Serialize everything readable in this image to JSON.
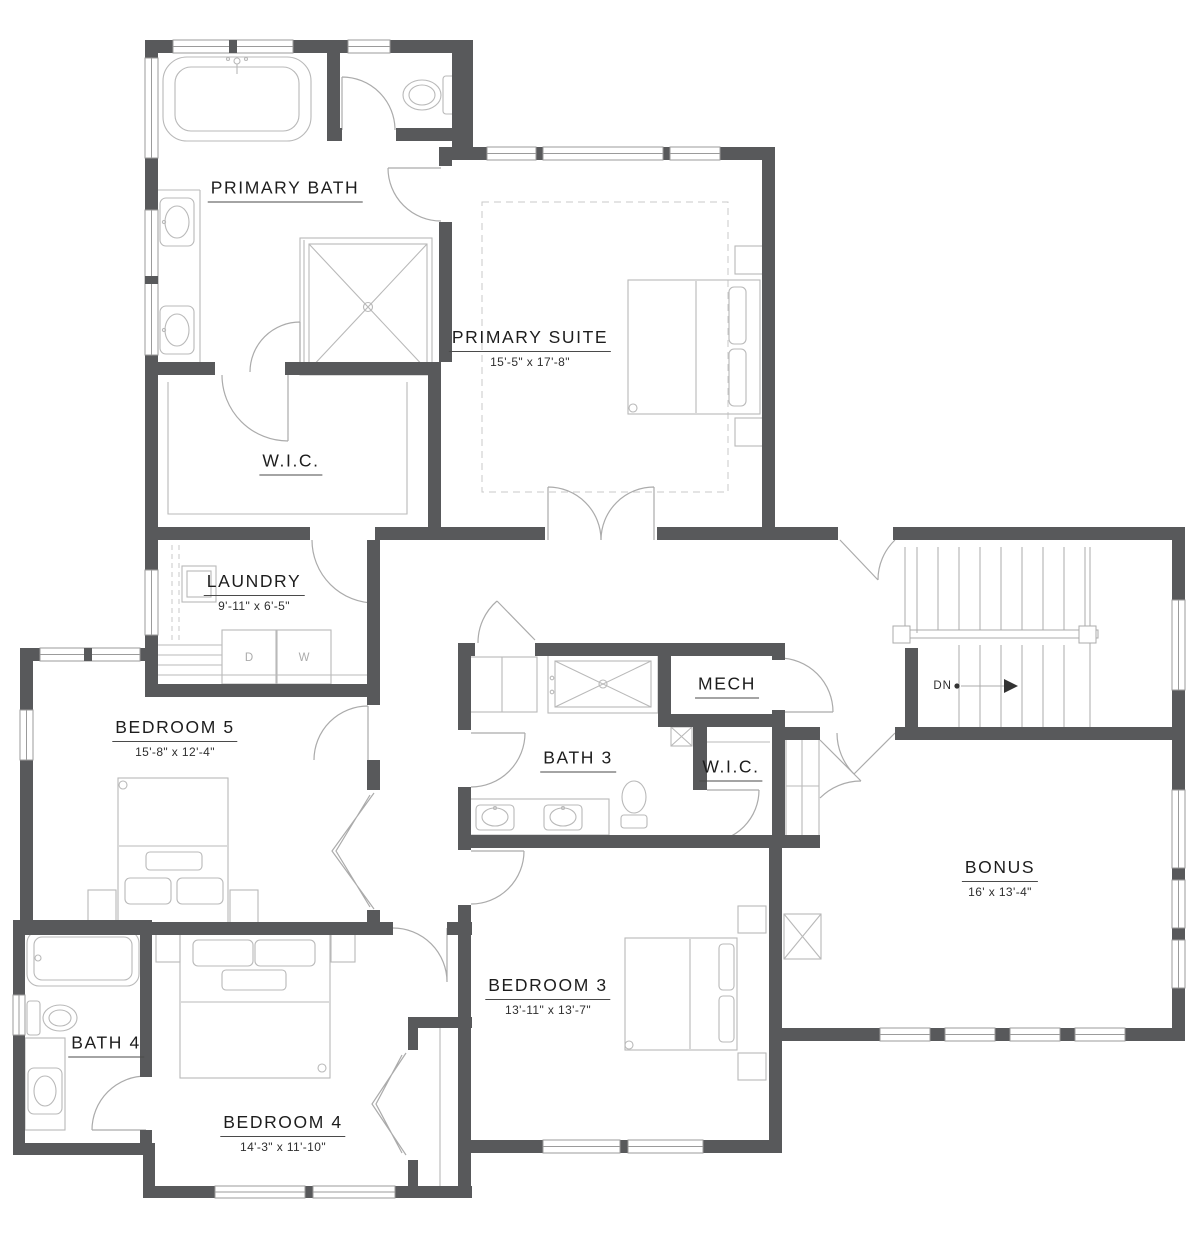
{
  "plan": {
    "rooms": [
      {
        "id": "primary-bath",
        "label": "PRIMARY BATH",
        "dims": ""
      },
      {
        "id": "primary-suite",
        "label": "PRIMARY SUITE",
        "dims": "15'-5\" x 17'-8\""
      },
      {
        "id": "primary-wic",
        "label": "W.I.C.",
        "dims": ""
      },
      {
        "id": "laundry",
        "label": "LAUNDRY",
        "dims": "9'-11\" x 6'-5\""
      },
      {
        "id": "bedroom-5",
        "label": "BEDROOM 5",
        "dims": "15'-8\" x 12'-4\""
      },
      {
        "id": "bath-3",
        "label": "BATH 3",
        "dims": ""
      },
      {
        "id": "mech",
        "label": "MECH",
        "dims": ""
      },
      {
        "id": "wic-2",
        "label": "W.I.C.",
        "dims": ""
      },
      {
        "id": "bonus",
        "label": "BONUS",
        "dims": "16' x 13'-4\""
      },
      {
        "id": "bedroom-3",
        "label": "BEDROOM 3",
        "dims": "13'-11\" x 13'-7\""
      },
      {
        "id": "bath-4",
        "label": "BATH 4",
        "dims": ""
      },
      {
        "id": "bedroom-4",
        "label": "BEDROOM 4",
        "dims": "14'-3\" x 11'-10\""
      }
    ],
    "stairs": {
      "down_label": "DN"
    },
    "appliances": {
      "dryer_label": "D",
      "washer_label": "W"
    },
    "colors": {
      "wall": "#58595b",
      "fixture_line": "#b9b9b9",
      "door_line": "#ababab",
      "text": "#1d1d1d"
    }
  }
}
